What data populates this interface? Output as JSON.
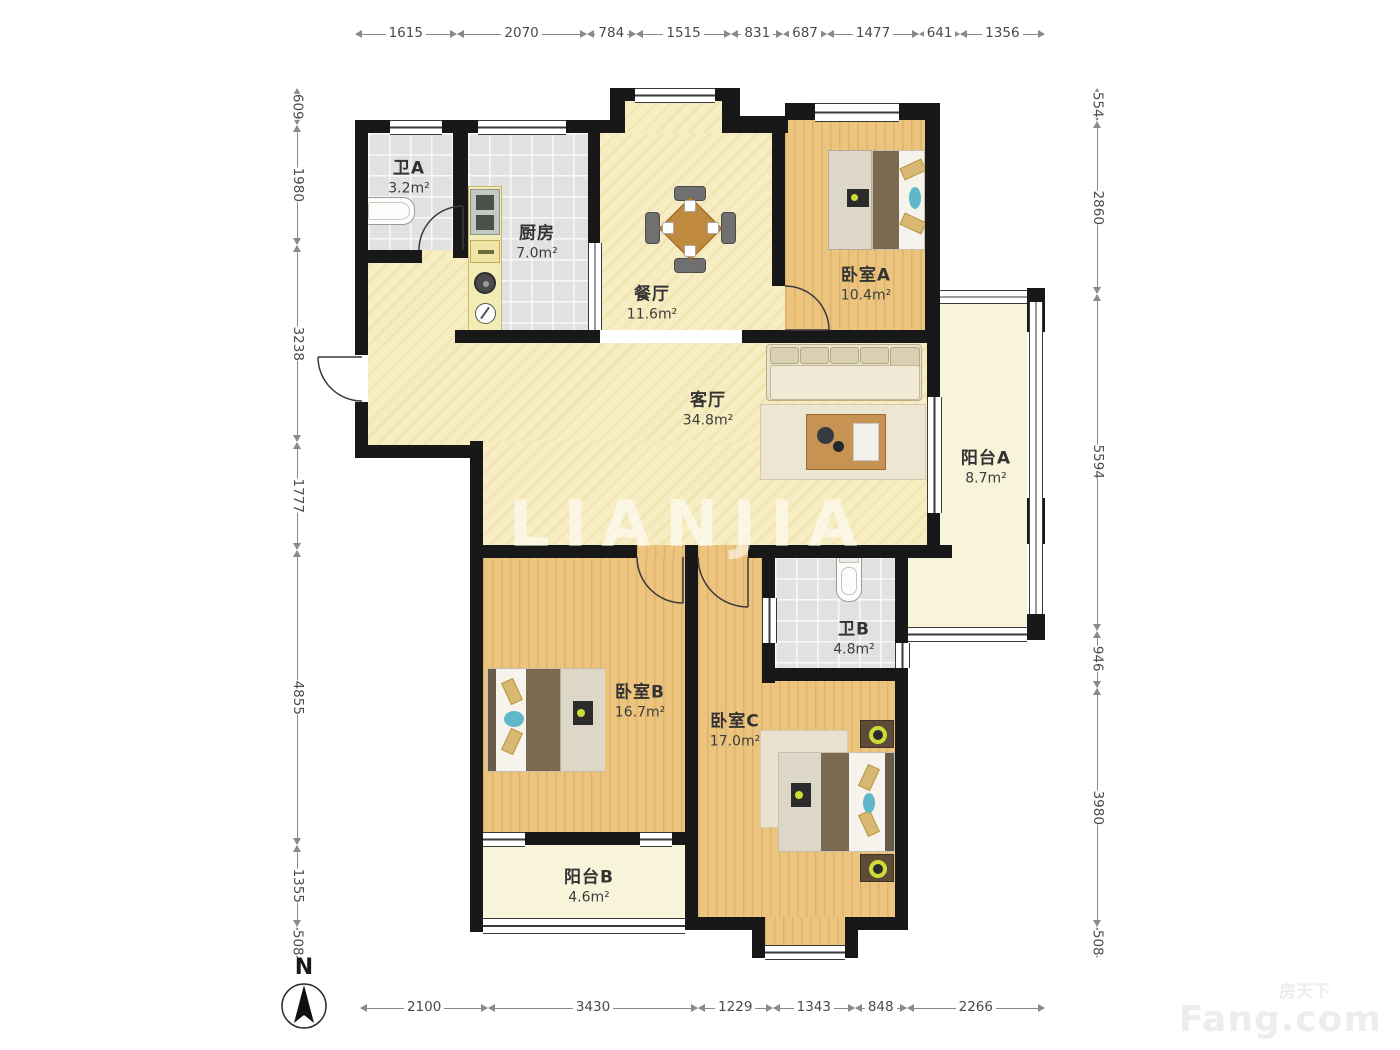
{
  "rooms": [
    {
      "id": "bathA",
      "name": "卫A",
      "area": "3.2m²"
    },
    {
      "id": "kitchen",
      "name": "厨房",
      "area": "7.0m²"
    },
    {
      "id": "dining",
      "name": "餐厅",
      "area": "11.6m²"
    },
    {
      "id": "bedA",
      "name": "卧室A",
      "area": "10.4m²"
    },
    {
      "id": "living",
      "name": "客厅",
      "area": "34.8m²"
    },
    {
      "id": "balconyA",
      "name": "阳台A",
      "area": "8.7m²"
    },
    {
      "id": "bathB",
      "name": "卫B",
      "area": "4.8m²"
    },
    {
      "id": "bedB",
      "name": "卧室B",
      "area": "16.7m²"
    },
    {
      "id": "bedC",
      "name": "卧室C",
      "area": "17.0m²"
    },
    {
      "id": "balconyB",
      "name": "阳台B",
      "area": "4.6m²"
    }
  ],
  "dimensions": {
    "top": [
      1615,
      2070,
      784,
      1515,
      831,
      687,
      1477,
      641,
      1356
    ],
    "bottom": [
      2100,
      3430,
      1229,
      1343,
      848,
      2266
    ],
    "left": [
      609,
      1980,
      3238,
      1777,
      4855,
      1355,
      508
    ],
    "right": [
      554,
      2860,
      5594,
      946,
      3980,
      508
    ]
  },
  "compass": {
    "label": "N"
  },
  "watermarks": {
    "center": "LIANJIA",
    "corner_line1": "房天下",
    "corner_line2": "Fang.com"
  },
  "colors": {
    "wall": "#181818",
    "wood_floor": "#ecc47e",
    "cream_floor": "#f7edc3",
    "tile_floor": "#e0e2e1",
    "balcony_floor": "#f7f4da",
    "dimension_text": "#4a4a4a"
  }
}
